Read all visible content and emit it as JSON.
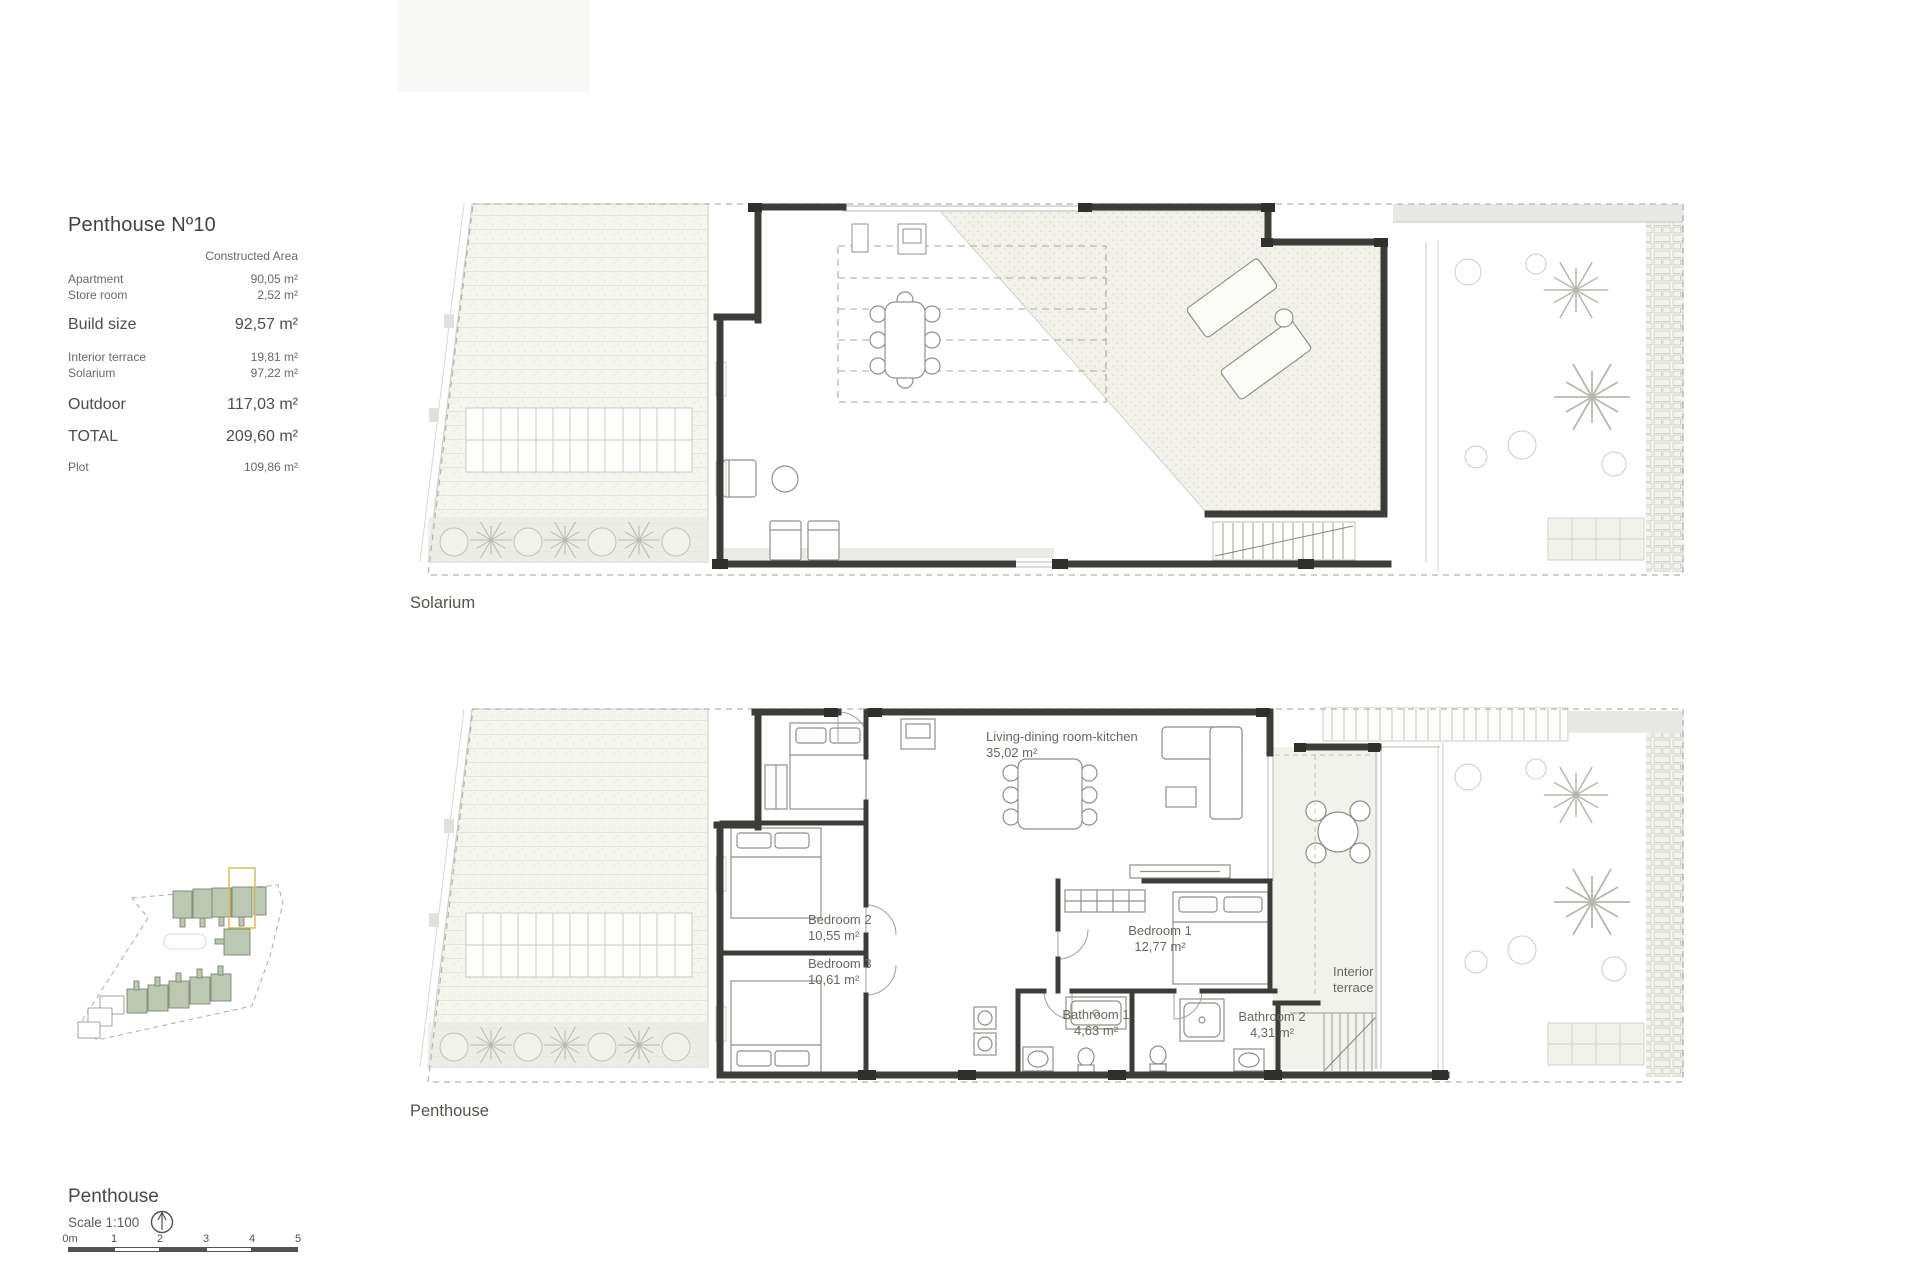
{
  "info_panel": {
    "title": "Penthouse Nº10",
    "column_header": "Constructed Area",
    "rows": [
      {
        "label": "Apartment",
        "value": "90,05 m²"
      },
      {
        "label": "Store room",
        "value": "2,52 m²"
      },
      {
        "label": "Build size",
        "value": "92,57 m²"
      },
      {
        "label": "Interior terrace",
        "value": "19,81 m²"
      },
      {
        "label": "Solarium",
        "value": "97,22 m²"
      },
      {
        "label": "Outdoor",
        "value": "117,03 m²"
      },
      {
        "label": "TOTAL",
        "value": "209,60 m²"
      },
      {
        "label": "Plot",
        "value": "109,86 m²"
      }
    ]
  },
  "plans": {
    "solarium": {
      "caption": "Solarium"
    },
    "penthouse": {
      "caption": "Penthouse",
      "labels": {
        "living": {
          "name": "Living-dining room-kitchen",
          "area": "35,02 m²"
        },
        "bedroom2": {
          "name": "Bedroom 2",
          "area": "10,55 m²"
        },
        "bedroom3": {
          "name": "Bedroom 3",
          "area": "10,61 m²"
        },
        "bedroom1": {
          "name": "Bedroom 1",
          "area": "12,77 m²"
        },
        "bathroom1": {
          "name": "Bathroom 1",
          "area": "4,63 m²"
        },
        "bathroom2": {
          "name": "Bathroom 2",
          "area": "4,31 m²"
        },
        "interior_terrace": {
          "line1": "Interior",
          "line2": "terrace"
        }
      }
    }
  },
  "footer": {
    "title": "Penthouse",
    "scale_label": "Scale 1:100",
    "north_icon": "north-arrow-icon",
    "scale_bar_labels": [
      "0m",
      "1",
      "2",
      "3",
      "4",
      "5"
    ]
  },
  "colors": {
    "wall": "#3c3c39",
    "text_dark": "#4a4742",
    "text_muted": "#6b675f",
    "site_plan_green": "#bcc8b2",
    "highlight_yellow": "#d8c35a"
  }
}
